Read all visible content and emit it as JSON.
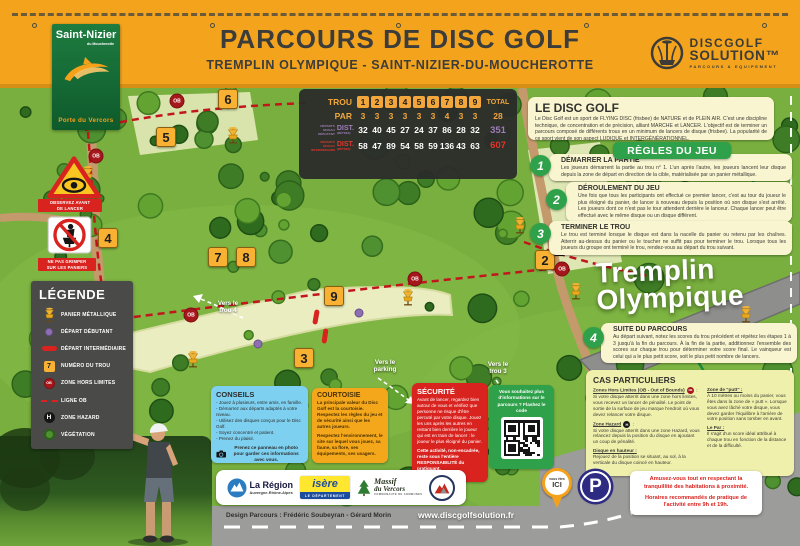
{
  "header": {
    "title": "PARCOURS DE DISC GOLF",
    "subtitle": "TREMPLIN OLYMPIQUE - SAINT-NIZIER-DU-MOUCHEROTTE",
    "town_logo": {
      "name": "Saint-Nizier",
      "sub": "du Moucherotte",
      "tagline": "Porte du Vercors"
    },
    "brand_logo": {
      "line1": "DISCGOLF",
      "line2": "SOLUTION™",
      "tagline": "PARCOURS & EQUIPEMENT"
    }
  },
  "scorecard": {
    "trou_label": "TROU",
    "par_label": "PAR",
    "total_label": "TOTAL",
    "dist_label": "DIST.",
    "dist_unit": "(MÈTRES)",
    "holes": [
      "1",
      "2",
      "3",
      "4",
      "5",
      "6",
      "7",
      "8",
      "9"
    ],
    "par": [
      "3",
      "3",
      "3",
      "3",
      "3",
      "3",
      "4",
      "3",
      "3"
    ],
    "par_total": "28",
    "beginner": {
      "label": "DÉPARTS NIVEAU DÉBUTANT",
      "values": [
        "32",
        "40",
        "45",
        "27",
        "24",
        "37",
        "86",
        "28",
        "32"
      ],
      "total": "351"
    },
    "intermediate": {
      "label": "DÉPARTS NIVEAU INTERMÉDIAIRE",
      "values": [
        "58",
        "47",
        "89",
        "54",
        "58",
        "59",
        "136",
        "43",
        "63"
      ],
      "total": "607"
    }
  },
  "intro": {
    "title": "LE DISC GOLF",
    "body": "Le Disc Golf est un sport de FLYING DISC (frisbee) de NATURE et de PLEIN AIR. C'est une discipline technique, de concentration et de précision, alliant MARCHE et LANCER. L'objectif est de terminer un parcours composé de différents trous en un minimum de lancers de disque (frisbee). La popularité de ce sport vient de son aspect LUDIQUE et INTERGÉNÉRATIONNEL."
  },
  "rules": {
    "badge": "RÈGLES DU JEU",
    "steps": [
      {
        "num": "1",
        "title": "DÉMARRER LA PARTIE",
        "body": "Les joueurs démarrent la partie au trou n° 1. L'un après l'autre, les joueurs lancent leur disque depuis la zone de départ en direction de la cible, matérialisée par un panier métallique."
      },
      {
        "num": "2",
        "title": "DÉROULEMENT DU JEU",
        "body": "Une fois que tous les participants ont effectué ce premier lancer, c'est au tour du joueur le plus éloigné du panier, de lancer à nouveau depuis la position où son disque s'est arrêté. Les joueurs dont ce n'est pas le tour attendent derrière le lanceur. Chaque lancer peut être effectué avec le même disque ou un disque différent."
      },
      {
        "num": "3",
        "title": "TERMINER LE TROU",
        "body": "Le trou est terminé lorsque le disque est dans la nacelle du panier ou retenu par les chaînes. Atterrir au-dessus du panier ou le toucher ne suffit pas pour terminer le trou. Lorsque tous les joueurs du groupe ont terminé le trou, rendez-vous au départ du trou suivant."
      },
      {
        "num": "4",
        "title": "SUITE DU PARCOURS",
        "body": "Au départ suivant, notez les scores du trou précédent et répétez les étapes 1 à 3 jusqu'à la fin du parcours. À la fin de la partie, additionnez l'ensemble des scores sur chaque trou pour déterminer votre score final. Le vainqueur est celui qui a le plus petit score, soit le plus petit nombre de lancers."
      }
    ]
  },
  "special_cases": {
    "title": "CAS PARTICULIERS",
    "left": [
      {
        "head": "Zones Hors Limites (OB - Out of Bounds)",
        "icon_text": "OB",
        "body": "Si votre disque atterrit dans une zone hors limites, vous recevez un lancer de pénalité. Le point de sortie de la surface de jeu marque l'endroit où vous devez relancer votre disque."
      },
      {
        "head": "Zone Hazard",
        "icon_text": "H",
        "body": "Si votre disque atterrit dans une zone Hazard, vous relancez depuis la position du disque en ajoutant un coup de pénalité."
      },
      {
        "head": "Disque en hauteur :",
        "body": "Rejouez de la position se situant, au sol, à la verticale du disque coincé en hauteur."
      }
    ],
    "right": [
      {
        "head": "Zone de \"putt\" :",
        "body": "À 10 mètres ou moins du panier, vous êtes dans la zone de « putt ». Lorsque vous avez lâché votre disque, vous devez garder l'équilibre à l'arrière de votre position sans tomber en avant."
      },
      {
        "head": "Le Par :",
        "body": "Il s'agit d'un score idéal attribué à chaque trou en fonction de la distance et de la difficulté."
      }
    ]
  },
  "legend": {
    "title": "LÉGENDE",
    "items": [
      {
        "icon": "basket",
        "label": "PANIER MÉTALLIQUE"
      },
      {
        "icon": "start-beginner",
        "label": "DÉPART DÉBUTANT"
      },
      {
        "icon": "start-intermediate",
        "label": "DÉPART INTERMÉDIAIRE"
      },
      {
        "icon": "tee",
        "sample": "7",
        "label": "NUMÉRO DU TROU"
      },
      {
        "icon": "ob",
        "sample": "OB",
        "label": "ZONE HORS LIMITES"
      },
      {
        "icon": "ob-line",
        "label": "LIGNE OB"
      },
      {
        "icon": "hazard",
        "sample": "H",
        "label": "ZONE HAZARD"
      },
      {
        "icon": "vegetation",
        "label": "VÉGÉTATION"
      }
    ]
  },
  "tips": {
    "title": "CONSEILS",
    "bullets": [
      "Jouez à plusieurs, entre amis, en famille.",
      "Démarrez aux départs adaptés à votre niveau.",
      "Utilisez des disques conçus pour le Disc Golf.",
      "Soyez concentré et patient.",
      "Prenez du plaisir."
    ],
    "photo_note": "Prenez ce panneau en photo pour garder ces informations avec vous."
  },
  "courtesy": {
    "title": "COURTOISIE",
    "p1": "La principale valeur du Disc Golf est la courtoisie. Respectez les règles du jeu et de sécurité ainsi que les autres joueurs.",
    "p2": "Respectez l'environnement, le site sur lequel vous jouez, sa faune, sa flore, ses équipements, ses usagers."
  },
  "safety": {
    "title": "SÉCURITÉ",
    "p1": "Avant de lancer, regardez bien autour de vous et vérifiez que personne ne risque d'être percuté par votre disque. Jouez les uns après les autres en restant bien derrière le joueur qui est en train de lancer : le joueur le plus éloigné du panier.",
    "p2": "Cette activité, non-encadrée, reste sous l'entière RESPONSABILITÉ du pratiquant."
  },
  "qr_panel": {
    "text": "Vous souhaitez plus d'informations sur le parcours ? Flashez le code"
  },
  "map": {
    "big_label_line1": "Tremplin",
    "big_label_line2": "Olympique",
    "you_are_here": {
      "line1": "vous êtes",
      "line2": "ICI"
    },
    "parking_label": "P",
    "basket_sign": "ST. PRO BASKET",
    "warning_signs": [
      {
        "label1": "OBSERVEZ AVANT",
        "label2": "DE LANCER"
      },
      {
        "label1": "NE PAS GRIMPER",
        "label2": "SUR LES PANIERS"
      }
    ],
    "nav_labels": [
      {
        "line1": "Vers le",
        "line2": "trou 4",
        "x": 228,
        "y": 307
      },
      {
        "line1": "Vers le",
        "line2": "parking",
        "x": 385,
        "y": 366
      },
      {
        "line1": "Vers le",
        "line2": "trou 3",
        "x": 498,
        "y": 368
      }
    ],
    "markers": [
      {
        "type": "tee",
        "label": "6",
        "x": 228,
        "y": 99
      },
      {
        "type": "tee",
        "label": "5",
        "x": 166,
        "y": 137
      },
      {
        "type": "tee",
        "label": "4",
        "x": 108,
        "y": 238
      },
      {
        "type": "tee",
        "label": "7",
        "x": 218,
        "y": 257
      },
      {
        "type": "tee",
        "label": "8",
        "x": 246,
        "y": 257
      },
      {
        "type": "tee",
        "label": "9",
        "x": 334,
        "y": 296
      },
      {
        "type": "tee",
        "label": "3",
        "x": 304,
        "y": 358
      },
      {
        "type": "tee",
        "label": "1",
        "x": 563,
        "y": 170
      },
      {
        "type": "tee",
        "label": "2",
        "x": 545,
        "y": 260
      },
      {
        "type": "ob",
        "label": "OB",
        "x": 177,
        "y": 101
      },
      {
        "type": "ob",
        "label": "OB",
        "x": 96,
        "y": 156
      },
      {
        "type": "ob",
        "label": "OB",
        "x": 191,
        "y": 315
      },
      {
        "type": "ob",
        "label": "OB",
        "x": 415,
        "y": 279
      },
      {
        "type": "ob",
        "label": "OB",
        "x": 562,
        "y": 269
      },
      {
        "type": "hazard",
        "label": "H",
        "x": 559,
        "y": 249
      },
      {
        "type": "basket",
        "x": 233,
        "y": 135
      },
      {
        "type": "basket",
        "x": 88,
        "y": 174
      },
      {
        "type": "basket",
        "x": 408,
        "y": 297
      },
      {
        "type": "basket",
        "x": 193,
        "y": 359
      },
      {
        "type": "basket",
        "x": 520,
        "y": 225
      },
      {
        "type": "basket",
        "x": 576,
        "y": 291
      },
      {
        "type": "basket",
        "x": 746,
        "y": 314
      },
      {
        "type": "start-beginner",
        "x": 359,
        "y": 313
      },
      {
        "type": "start-beginner",
        "x": 258,
        "y": 344
      },
      {
        "type": "start-intermediate",
        "x": 316,
        "y": 317,
        "rot": 10
      },
      {
        "type": "start-intermediate",
        "x": 325,
        "y": 336,
        "rot": 8
      }
    ]
  },
  "footer": {
    "partners": {
      "region": {
        "line1": "La Région",
        "line2": "Auvergne-Rhône-Alpes"
      },
      "isere": {
        "name": "isère",
        "sub": "LE DÉPARTEMENT"
      },
      "massif": {
        "line1": "Massif",
        "line2": "du Vercors",
        "sub": "COMMUNAUTÉ DE COMMUNES"
      }
    },
    "credit": "Design Parcours : Frédéric Soubeyran - Gérard Morin",
    "website": "www.discgolfsolution.fr",
    "notice": {
      "p1": "Amusez-vous tout en respectant la tranquillité des habitations à proximité.",
      "p2": "Horaires recommandés de pratique de l'activité entre 9h et 19h."
    }
  }
}
